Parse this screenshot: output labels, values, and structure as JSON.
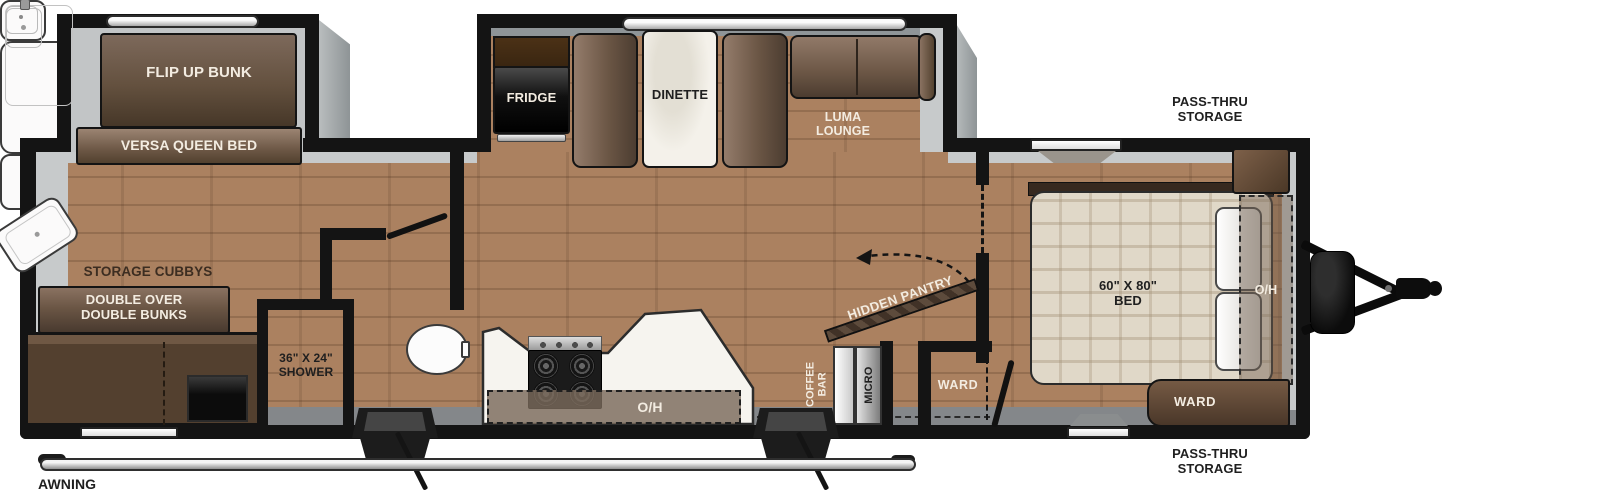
{
  "plan": {
    "bunk_room": {
      "flip_up_bunk": "FLIP UP BUNK",
      "versa_queen_bed": "VERSA QUEEN BED",
      "storage_cubbys": "STORAGE CUBBYS",
      "double_bunks": "DOUBLE OVER\nDOUBLE BUNKS",
      "shower": "36\" X 24\"\nSHOWER"
    },
    "kitchen": {
      "fridge": "FRIDGE",
      "dinette": "DINETTE",
      "luma_lounge": "LUMA\nLOUNGE",
      "overhead": "O/H",
      "coffee_bar": "COFFEE\nBAR",
      "micro": "MICRO",
      "hidden_pantry": "HIDDEN PANTRY"
    },
    "hall": {
      "ward": "WARD"
    },
    "bedroom": {
      "bed": "60\" X 80\"\nBED",
      "overhead": "O/H",
      "ward": "WARD"
    },
    "exterior": {
      "pass_thru_front_top": "PASS-THRU\nSTORAGE",
      "pass_thru_front_bottom": "PASS-THRU\nSTORAGE",
      "awning": "AWNING"
    }
  },
  "colors": {
    "wall": "#141414",
    "floor_wood": "#ab8160",
    "slideout_floor_gray": "#c2c5c6",
    "furniture_brown": "#6b5645",
    "counter_white": "#f6f4ef",
    "appliance_black": "#161616",
    "bed_plaid": "#e0d8c8"
  }
}
